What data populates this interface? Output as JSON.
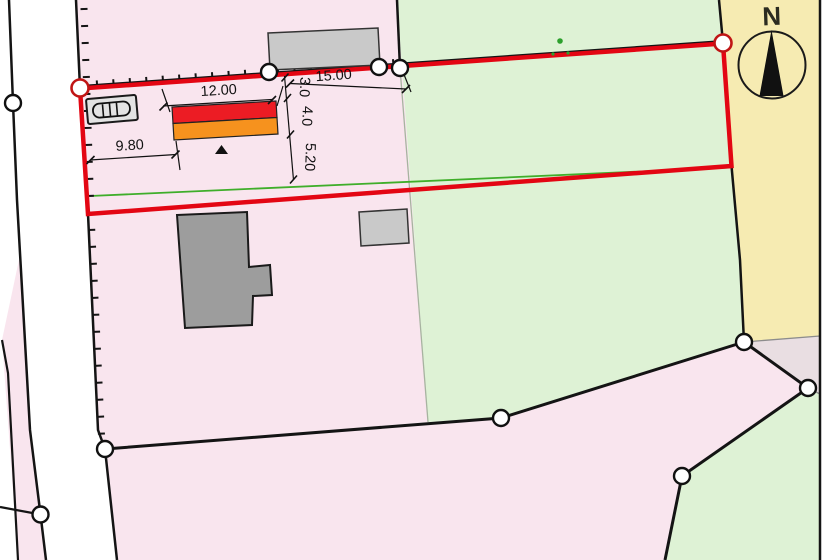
{
  "title": "Cadastral site plan",
  "compass": {
    "label": "N"
  },
  "dimensions": {
    "building_width": "12.00",
    "east_distance": "15.00",
    "west_distance": "9.80",
    "north_offset": "3.0",
    "building_depth": "4.0",
    "south_offset": "5.20"
  },
  "colors": {
    "parcel_pink": "#f9e5ee",
    "parcel_green": "#def2d5",
    "parcel_yellow": "#f6ebb2",
    "parcel_mauve": "#e9dee2",
    "boundary_red": "#e30613",
    "building_red": "#ec1c24",
    "building_orange": "#f6921e",
    "building_gray": "#9d9d9d",
    "building_lightgray": "#c9c9c9",
    "line_green": "#3fae2a",
    "line_black": "#141414",
    "point_fill": "#ffffff"
  }
}
